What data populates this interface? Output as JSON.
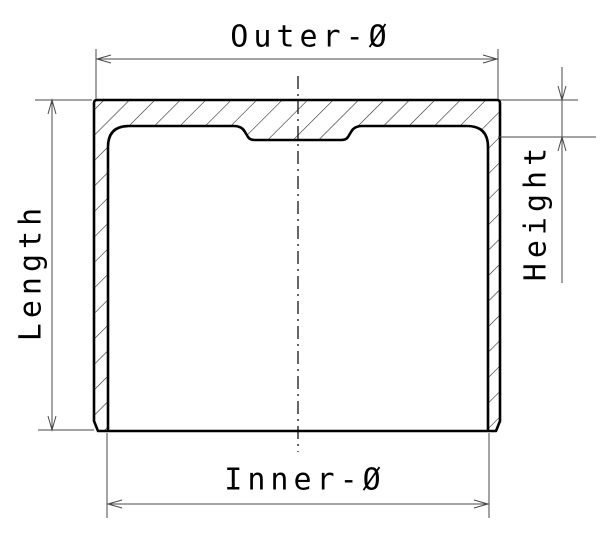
{
  "diagram": {
    "type": "technical-drawing-cross-section",
    "background": "#ffffff",
    "part_line_color": "#000000",
    "dimension_line_color": "#4a4a4a",
    "hatch_color": "#1a1a1a",
    "labels": {
      "top": "Outer-Ø",
      "bottom": "Inner-Ø",
      "left": "Length",
      "right": "Height"
    }
  }
}
